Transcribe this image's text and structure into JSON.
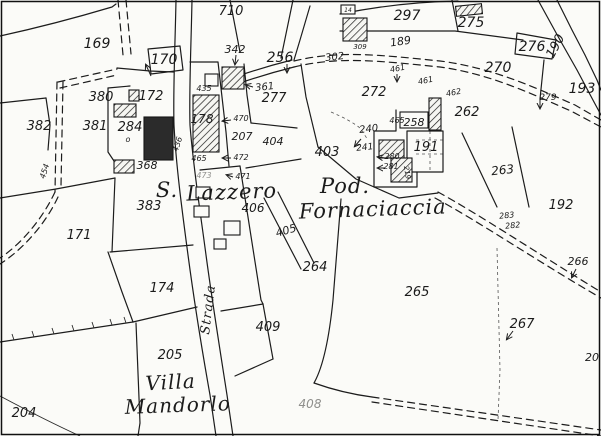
{
  "map": {
    "kind": "cadastral-map",
    "place_names": [
      "S. Lazzero",
      "Pod. Fornaciaccia",
      "Villa Mandorlo"
    ],
    "road_name": "Strada",
    "colors": {
      "paper": "#fbfbf8",
      "ink": "#1b1b1b",
      "building_dark": "#2b2b2b",
      "faint": "#8f8f8c"
    },
    "labels": [
      {
        "t": "S.",
        "x": 167,
        "y": 197,
        "s": 21,
        "c": "p"
      },
      {
        "t": "Lazzero",
        "x": 232,
        "y": 199,
        "s": 21,
        "c": "p",
        "r": -2
      },
      {
        "t": "Pod.",
        "x": 345,
        "y": 193,
        "s": 21,
        "c": "p"
      },
      {
        "t": "Fornaciaccia",
        "x": 373,
        "y": 216,
        "s": 21,
        "c": "p",
        "r": -2
      },
      {
        "t": "Villa",
        "x": 171,
        "y": 389,
        "s": 20,
        "c": "p",
        "r": -3
      },
      {
        "t": "Mandorlo",
        "x": 178,
        "y": 412,
        "s": 20,
        "c": "p",
        "r": -2
      },
      {
        "t": "Strada",
        "x": 212,
        "y": 310,
        "s": 13,
        "c": "p",
        "r": -83
      },
      {
        "t": "169",
        "x": 97,
        "y": 48,
        "s": 14
      },
      {
        "t": "710",
        "x": 231,
        "y": 15,
        "s": 13
      },
      {
        "t": "170",
        "x": 164,
        "y": 64,
        "s": 14
      },
      {
        "t": "342",
        "x": 235,
        "y": 53,
        "s": 11
      },
      {
        "t": "256",
        "x": 280,
        "y": 62,
        "s": 14
      },
      {
        "t": "297",
        "x": 407,
        "y": 20,
        "s": 14
      },
      {
        "t": "189",
        "x": 401,
        "y": 45,
        "s": 11,
        "r": -8
      },
      {
        "t": "302",
        "x": 335,
        "y": 60,
        "s": 10,
        "r": -6
      },
      {
        "t": "309",
        "x": 360,
        "y": 49,
        "s": 7
      },
      {
        "t": "14",
        "x": 348,
        "y": 12,
        "s": 6
      },
      {
        "t": "275",
        "x": 471,
        "y": 27,
        "s": 14
      },
      {
        "t": "276",
        "x": 532,
        "y": 51,
        "s": 14
      },
      {
        "t": "190",
        "x": 559,
        "y": 48,
        "s": 13,
        "r": -62
      },
      {
        "t": "270",
        "x": 498,
        "y": 72,
        "s": 14
      },
      {
        "t": "193",
        "x": 582,
        "y": 93,
        "s": 14
      },
      {
        "t": "279",
        "x": 548,
        "y": 100,
        "s": 9
      },
      {
        "t": "272",
        "x": 374,
        "y": 96,
        "s": 13
      },
      {
        "t": "262",
        "x": 467,
        "y": 116,
        "s": 13
      },
      {
        "t": "258",
        "x": 414,
        "y": 126,
        "s": 11
      },
      {
        "t": "191",
        "x": 426,
        "y": 151,
        "s": 13
      },
      {
        "t": "403",
        "x": 327,
        "y": 156,
        "s": 13
      },
      {
        "t": "240",
        "x": 369,
        "y": 132,
        "s": 10,
        "r": -6
      },
      {
        "t": "241",
        "x": 365,
        "y": 150,
        "s": 9,
        "r": -6
      },
      {
        "t": "280",
        "x": 392,
        "y": 159,
        "s": 8
      },
      {
        "t": "281",
        "x": 391,
        "y": 169,
        "s": 8
      },
      {
        "t": "219",
        "x": 405,
        "y": 173,
        "s": 7,
        "r": 80
      },
      {
        "t": "461",
        "x": 398,
        "y": 71,
        "s": 8,
        "r": -10
      },
      {
        "t": "461",
        "x": 426,
        "y": 83,
        "s": 8,
        "r": -10
      },
      {
        "t": "462",
        "x": 454,
        "y": 95,
        "s": 8,
        "r": -10
      },
      {
        "t": "465",
        "x": 397,
        "y": 123,
        "s": 8
      },
      {
        "t": "263",
        "x": 503,
        "y": 174,
        "s": 12,
        "r": -6
      },
      {
        "t": "192",
        "x": 561,
        "y": 209,
        "s": 13
      },
      {
        "t": "283",
        "x": 507,
        "y": 218,
        "s": 8,
        "r": -6
      },
      {
        "t": "282",
        "x": 513,
        "y": 228,
        "s": 8,
        "r": -6
      },
      {
        "t": "264",
        "x": 315,
        "y": 271,
        "s": 13
      },
      {
        "t": "265",
        "x": 417,
        "y": 296,
        "s": 13
      },
      {
        "t": "267",
        "x": 522,
        "y": 328,
        "s": 13
      },
      {
        "t": "266",
        "x": 578,
        "y": 265,
        "s": 11
      },
      {
        "t": "20",
        "x": 592,
        "y": 361,
        "s": 11
      },
      {
        "t": "405",
        "x": 287,
        "y": 234,
        "s": 11,
        "r": -16
      },
      {
        "t": "406",
        "x": 253,
        "y": 212,
        "s": 12
      },
      {
        "t": "409",
        "x": 268,
        "y": 331,
        "s": 13
      },
      {
        "t": "408",
        "x": 310,
        "y": 408,
        "s": 12,
        "c": "f"
      },
      {
        "t": "174",
        "x": 162,
        "y": 292,
        "s": 13
      },
      {
        "t": "171",
        "x": 79,
        "y": 239,
        "s": 13
      },
      {
        "t": "205",
        "x": 170,
        "y": 359,
        "s": 13
      },
      {
        "t": "204",
        "x": 24,
        "y": 417,
        "s": 13
      },
      {
        "t": "383",
        "x": 149,
        "y": 210,
        "s": 13
      },
      {
        "t": "381",
        "x": 95,
        "y": 130,
        "s": 13
      },
      {
        "t": "382",
        "x": 39,
        "y": 130,
        "s": 13
      },
      {
        "t": "380",
        "x": 101,
        "y": 101,
        "s": 13
      },
      {
        "t": "284",
        "x": 130,
        "y": 131,
        "s": 13
      },
      {
        "t": "172",
        "x": 151,
        "y": 100,
        "s": 13
      },
      {
        "t": "178",
        "x": 202,
        "y": 123,
        "s": 12
      },
      {
        "t": "368",
        "x": 147,
        "y": 169,
        "s": 11
      },
      {
        "t": "435",
        "x": 204,
        "y": 91,
        "s": 8
      },
      {
        "t": "361",
        "x": 265,
        "y": 90,
        "s": 10,
        "r": -6
      },
      {
        "t": "277",
        "x": 274,
        "y": 102,
        "s": 13
      },
      {
        "t": "207",
        "x": 242,
        "y": 140,
        "s": 11
      },
      {
        "t": "404",
        "x": 273,
        "y": 145,
        "s": 11
      },
      {
        "t": "470",
        "x": 241,
        "y": 121,
        "s": 8
      },
      {
        "t": "472",
        "x": 241,
        "y": 160,
        "s": 8
      },
      {
        "t": "471",
        "x": 243,
        "y": 179,
        "s": 8
      },
      {
        "t": "465",
        "x": 199,
        "y": 161,
        "s": 8
      },
      {
        "t": "473",
        "x": 204,
        "y": 178,
        "s": 8,
        "c": "f"
      },
      {
        "t": "436",
        "x": 180,
        "y": 145,
        "s": 8,
        "r": -72
      },
      {
        "t": "454",
        "x": 47,
        "y": 172,
        "s": 8,
        "r": -72
      },
      {
        "t": "o",
        "x": 128,
        "y": 142,
        "s": 8
      }
    ]
  }
}
